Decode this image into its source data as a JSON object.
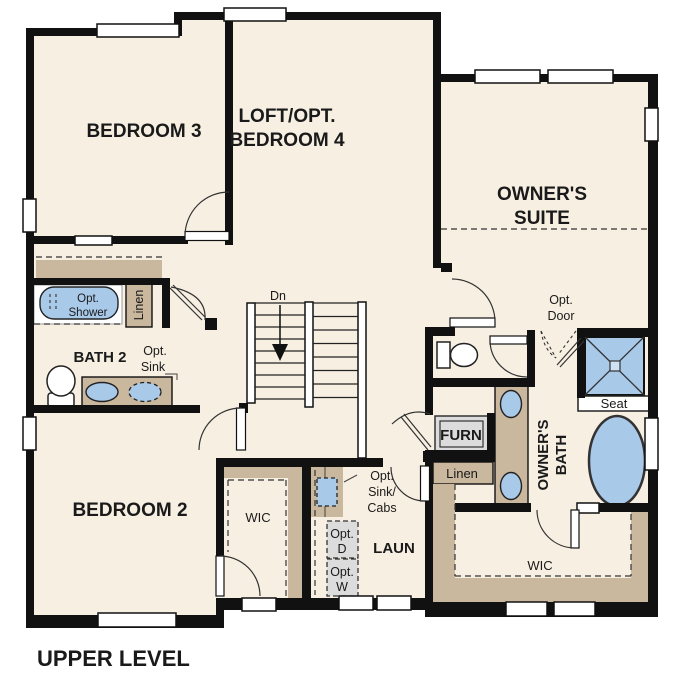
{
  "plan": {
    "title": "UPPER LEVEL"
  },
  "rooms": {
    "bedroom3": "BEDROOM 3",
    "loft_line1": "LOFT/OPT.",
    "loft_line2": "BEDROOM 4",
    "owners_suite_line1": "OWNER'S",
    "owners_suite_line2": "SUITE",
    "bedroom2": "BEDROOM 2",
    "bath2": "BATH 2",
    "laundry": "LAUN",
    "bedroom2_wic": "WIC",
    "owners_wic": "WIC",
    "owners_bath_line1": "OWNER'S",
    "owners_bath_line2": "BATH"
  },
  "labels": {
    "stairs_down": "Dn",
    "opt_shower_line1": "Opt.",
    "opt_shower_line2": "Shower",
    "bath2_linen": "Linen",
    "opt_sink_line1": "Opt.",
    "opt_sink_line2": "Sink",
    "opt_door_line1": "Opt.",
    "opt_door_line2": "Door",
    "shower_seat": "Seat",
    "furnace": "FURN",
    "owners_linen": "Linen",
    "opt_sink_cabs_line1": "Opt.",
    "opt_sink_cabs_line2": "Sink/",
    "opt_sink_cabs_line3": "Cabs",
    "opt_dryer_line1": "Opt.",
    "opt_dryer_line2": "D",
    "opt_washer_line1": "Opt.",
    "opt_washer_line2": "W"
  },
  "colors": {
    "wall": "#111111",
    "floor": "#f7efe2",
    "casework_tan": "#c9b79e",
    "fixture_blue": "#a9c9e9",
    "equipment_gray": "#dcdcdc",
    "background": "#ffffff"
  }
}
